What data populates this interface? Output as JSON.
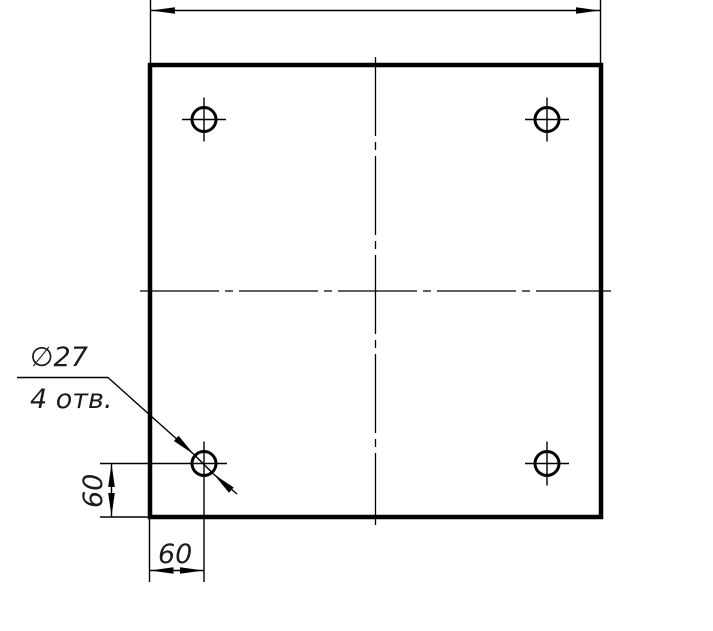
{
  "drawing": {
    "type": "engineering-drawing",
    "view": "square plate, front view, four drilled holes",
    "colors": {
      "background": "#ffffff",
      "line": "#000000",
      "text": "#1b1b1b"
    },
    "callout": {
      "diameter_label": "∅27",
      "count_label": "4 отв."
    },
    "dims": {
      "hole_offset_horizontal": "60",
      "hole_offset_vertical": "60",
      "overall_width_label": ""
    },
    "holes": {
      "count": 4,
      "diameter_text": "27",
      "offset_from_edges_text": "60"
    }
  }
}
